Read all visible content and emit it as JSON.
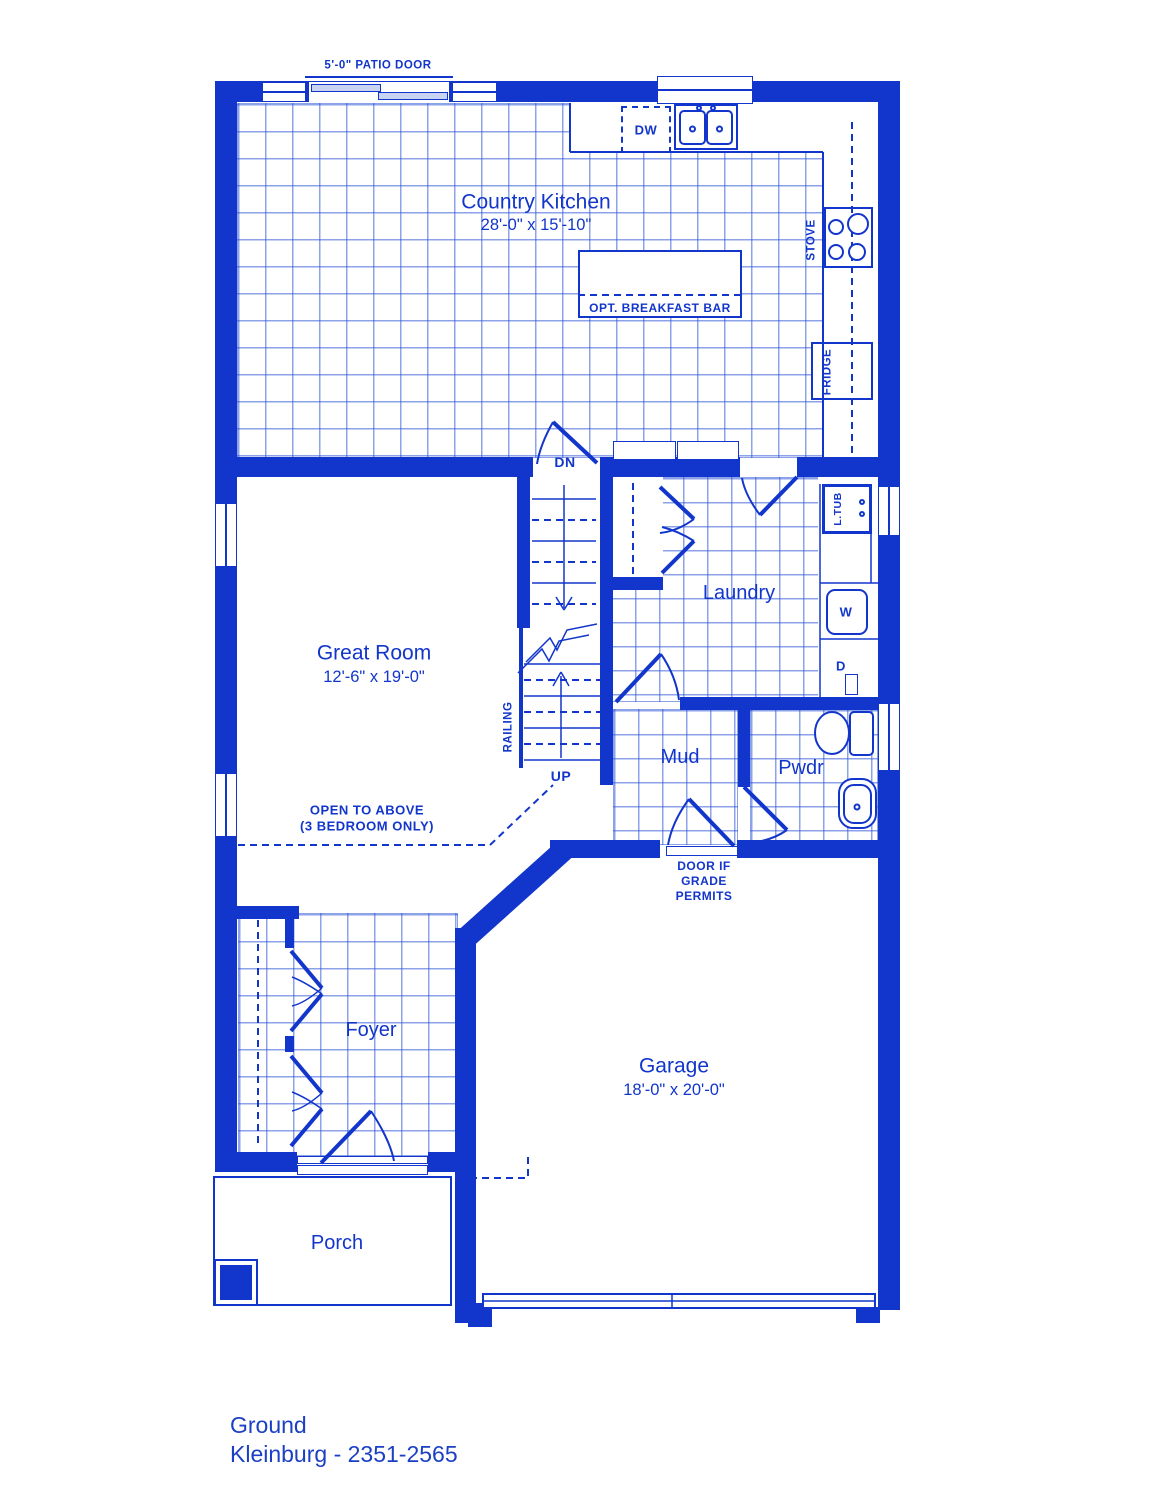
{
  "colors": {
    "ink": "#1236cb",
    "grid": "#2d55d7",
    "panel": "#c9d4f3",
    "footer": "#1c40c4"
  },
  "footer": {
    "floor": "Ground",
    "model": "Kleinburg - 2351-2565"
  },
  "rooms": {
    "kitchen": {
      "name": "Country Kitchen",
      "dims": "28'-0\" x 15'-10\""
    },
    "great_room": {
      "name": "Great Room",
      "dims": "12'-6\" x 19'-0\""
    },
    "laundry": {
      "name": "Laundry"
    },
    "mud": {
      "name": "Mud"
    },
    "pwdr": {
      "name": "Pwdr"
    },
    "foyer": {
      "name": "Foyer"
    },
    "garage": {
      "name": "Garage",
      "dims": "18'-0\" x 20'-0\""
    },
    "porch": {
      "name": "Porch"
    }
  },
  "labels": {
    "patio_door": "5'-0\" PATIO DOOR",
    "dw": "DW",
    "breakfast_bar": "OPT. BREAKFAST BAR",
    "stove": "STOVE",
    "fridge": "FRIDGE",
    "dn": "DN",
    "up": "UP",
    "railing": "RAILING",
    "laundry_tub": "L.TUB",
    "washer": "W",
    "dryer": "D",
    "open_above_line1": "OPEN TO ABOVE",
    "open_above_line2": "(3 BEDROOM ONLY)",
    "grade_door_line1": "DOOR IF",
    "grade_door_line2": "GRADE",
    "grade_door_line3": "PERMITS"
  }
}
